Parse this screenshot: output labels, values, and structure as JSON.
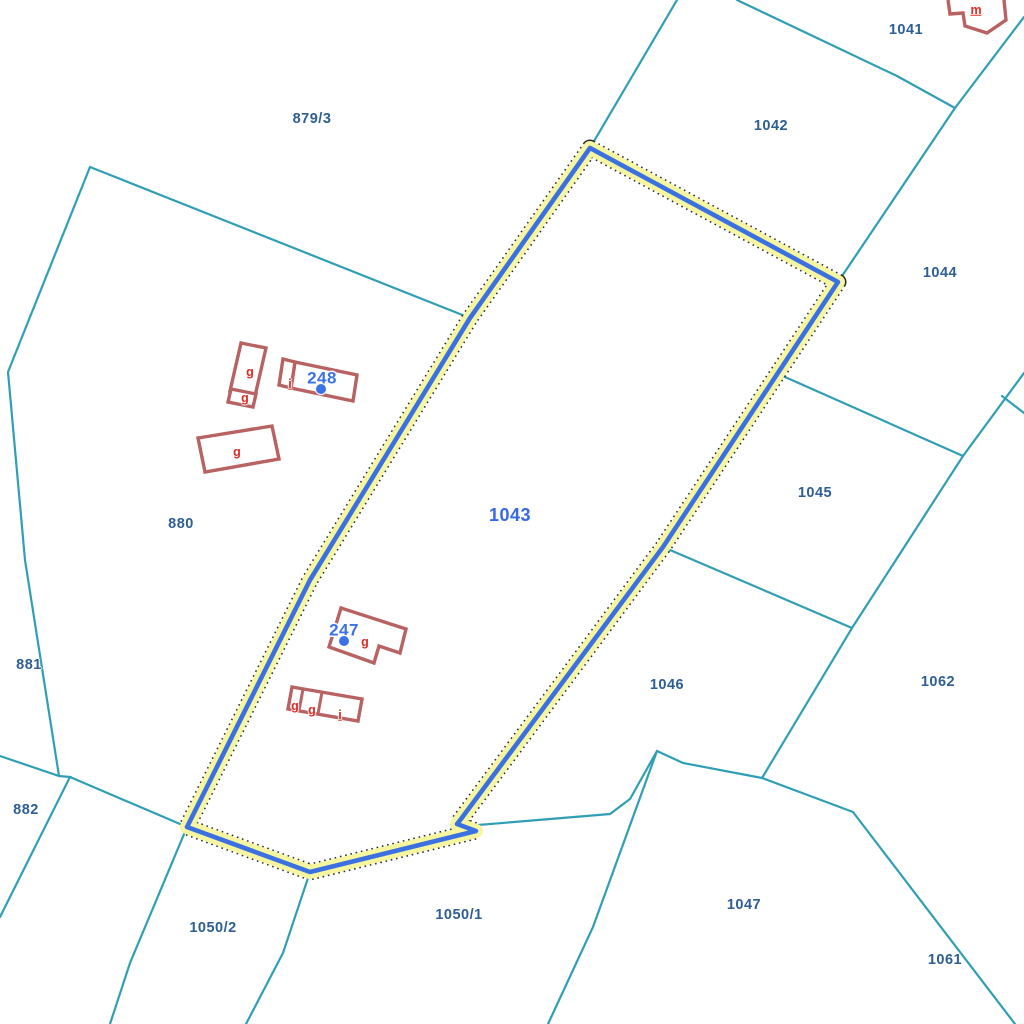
{
  "map": {
    "colors": {
      "background": "#ffffff",
      "boundary": "#309FB5",
      "parcel_label": "#2D5E94",
      "selected_label": "#3668E8",
      "building": "#B86262",
      "building_label": "#DE2A25",
      "house_number": "#3B72E8",
      "highlight_stroke": "#3B70E2",
      "highlight_halo": "#F6F6A0",
      "highlight_dash": "#2A2A2A"
    },
    "selected_parcel_label": {
      "text": "1043",
      "x": 510,
      "y": 515
    },
    "parcel_labels": [
      {
        "text": "879/3",
        "x": 312,
        "y": 119
      },
      {
        "text": "1041",
        "x": 906,
        "y": 30
      },
      {
        "text": "1042",
        "x": 771,
        "y": 126
      },
      {
        "text": "1044",
        "x": 940,
        "y": 273
      },
      {
        "text": "1045",
        "x": 815,
        "y": 493
      },
      {
        "text": "1046",
        "x": 667,
        "y": 685
      },
      {
        "text": "1062",
        "x": 938,
        "y": 682
      },
      {
        "text": "880",
        "x": 181,
        "y": 524
      },
      {
        "text": "881",
        "x": 29,
        "y": 665
      },
      {
        "text": "882",
        "x": 26,
        "y": 810
      },
      {
        "text": "1050/2",
        "x": 213,
        "y": 928
      },
      {
        "text": "1050/1",
        "x": 459,
        "y": 915
      },
      {
        "text": "1047",
        "x": 744,
        "y": 905
      },
      {
        "text": "1061",
        "x": 945,
        "y": 960
      }
    ],
    "building_labels": [
      {
        "text": "m",
        "x": 976,
        "y": 10
      },
      {
        "text": "i",
        "x": 290,
        "y": 384
      },
      {
        "text": "g",
        "x": 250,
        "y": 372
      },
      {
        "text": "g",
        "x": 245,
        "y": 398
      },
      {
        "text": "g",
        "x": 237,
        "y": 452
      },
      {
        "text": "g",
        "x": 365,
        "y": 642
      },
      {
        "text": "g",
        "x": 295,
        "y": 706
      },
      {
        "text": "g",
        "x": 312,
        "y": 710
      },
      {
        "text": "i",
        "x": 340,
        "y": 715
      }
    ],
    "house_numbers": [
      {
        "text": "248",
        "x": 322,
        "y": 378,
        "dot_x": 321,
        "dot_y": 389
      },
      {
        "text": "247",
        "x": 344,
        "y": 630,
        "dot_x": 344,
        "dot_y": 641
      }
    ],
    "highlighted_parcel": {
      "outline": [
        [
          590,
          148
        ],
        [
          838,
          282
        ],
        [
          663,
          547
        ],
        [
          461,
          819
        ],
        [
          457,
          824
        ],
        [
          476,
          831
        ],
        [
          310,
          872
        ],
        [
          187,
          827
        ],
        [
          310,
          580
        ],
        [
          470,
          318
        ]
      ]
    },
    "boundary_lines": [
      {
        "points": [
          [
            677,
            0
          ],
          [
            590,
            148
          ]
        ]
      },
      {
        "points": [
          [
            737,
            0
          ],
          [
            897,
            76
          ],
          [
            955,
            108
          ]
        ]
      },
      {
        "points": [
          [
            1024,
            17
          ],
          [
            955,
            108
          ]
        ]
      },
      {
        "points": [
          [
            955,
            108
          ],
          [
            838,
            282
          ]
        ]
      },
      {
        "points": [
          [
            776,
            373
          ],
          [
            963,
            456
          ]
        ]
      },
      {
        "points": [
          [
            1024,
            373
          ],
          [
            963,
            456
          ],
          [
            852,
            628
          ],
          [
            762,
            778
          ]
        ]
      },
      {
        "points": [
          [
            1002,
            396
          ],
          [
            1024,
            413
          ]
        ]
      },
      {
        "points": [
          [
            663,
            547
          ],
          [
            852,
            628
          ]
        ]
      },
      {
        "points": [
          [
            478,
            825
          ],
          [
            610,
            814
          ],
          [
            630,
            799
          ],
          [
            657,
            751
          ]
        ]
      },
      {
        "points": [
          [
            657,
            751
          ],
          [
            683,
            763
          ],
          [
            762,
            778
          ],
          [
            853,
            812
          ],
          [
            1015,
            1024
          ]
        ]
      },
      {
        "points": [
          [
            657,
            751
          ],
          [
            593,
            927
          ],
          [
            548,
            1024
          ]
        ]
      },
      {
        "points": [
          [
            187,
            827
          ],
          [
            130,
            963
          ],
          [
            110,
            1024
          ]
        ]
      },
      {
        "points": [
          [
            310,
            872
          ],
          [
            283,
            953
          ],
          [
            246,
            1024
          ]
        ]
      },
      {
        "points": [
          [
            90,
            167
          ],
          [
            8,
            372
          ],
          [
            25,
            560
          ],
          [
            59,
            776
          ]
        ]
      },
      {
        "points": [
          [
            90,
            167
          ],
          [
            470,
            318
          ]
        ]
      },
      {
        "points": [
          [
            59,
            776
          ],
          [
            0,
            756
          ]
        ]
      },
      {
        "points": [
          [
            59,
            776
          ],
          [
            70,
            777
          ],
          [
            20,
            877
          ],
          [
            0,
            917
          ]
        ]
      },
      {
        "points": [
          [
            70,
            777
          ],
          [
            187,
            827
          ]
        ]
      }
    ],
    "buildings": [
      {
        "closed": false,
        "outline": [
          [
            948,
            0
          ],
          [
            950,
            14
          ],
          [
            963,
            13
          ],
          [
            965,
            26
          ],
          [
            987,
            33
          ],
          [
            1006,
            20
          ],
          [
            1004,
            0
          ]
        ]
      },
      {
        "closed": true,
        "outline": [
          [
            295,
            362
          ],
          [
            357,
            375
          ],
          [
            353,
            401
          ],
          [
            291,
            388
          ]
        ]
      },
      {
        "closed": true,
        "outline": [
          [
            283,
            359
          ],
          [
            295,
            362
          ],
          [
            291,
            388
          ],
          [
            279,
            385
          ]
        ]
      },
      {
        "closed": true,
        "outline": [
          [
            241,
            343
          ],
          [
            266,
            348
          ],
          [
            255,
            396
          ],
          [
            230,
            391
          ]
        ]
      },
      {
        "closed": true,
        "outline": [
          [
            231,
            389
          ],
          [
            256,
            394
          ],
          [
            253,
            407
          ],
          [
            228,
            402
          ]
        ]
      },
      {
        "closed": true,
        "outline": [
          [
            198,
            438
          ],
          [
            272,
            426
          ],
          [
            279,
            459
          ],
          [
            205,
            472
          ]
        ]
      },
      {
        "closed": true,
        "outline": [
          [
            341,
            608
          ],
          [
            406,
            629
          ],
          [
            400,
            653
          ],
          [
            379,
            646
          ],
          [
            374,
            663
          ],
          [
            329,
            647
          ]
        ]
      },
      {
        "closed": true,
        "outline": [
          [
            292,
            687
          ],
          [
            362,
            699
          ],
          [
            358,
            721
          ],
          [
            288,
            709
          ]
        ],
        "dividers": [
          [
            [
              303,
              689
            ],
            [
              299,
              711
            ]
          ],
          [
            [
              322,
              692
            ],
            [
              318,
              714
            ]
          ]
        ]
      }
    ]
  }
}
